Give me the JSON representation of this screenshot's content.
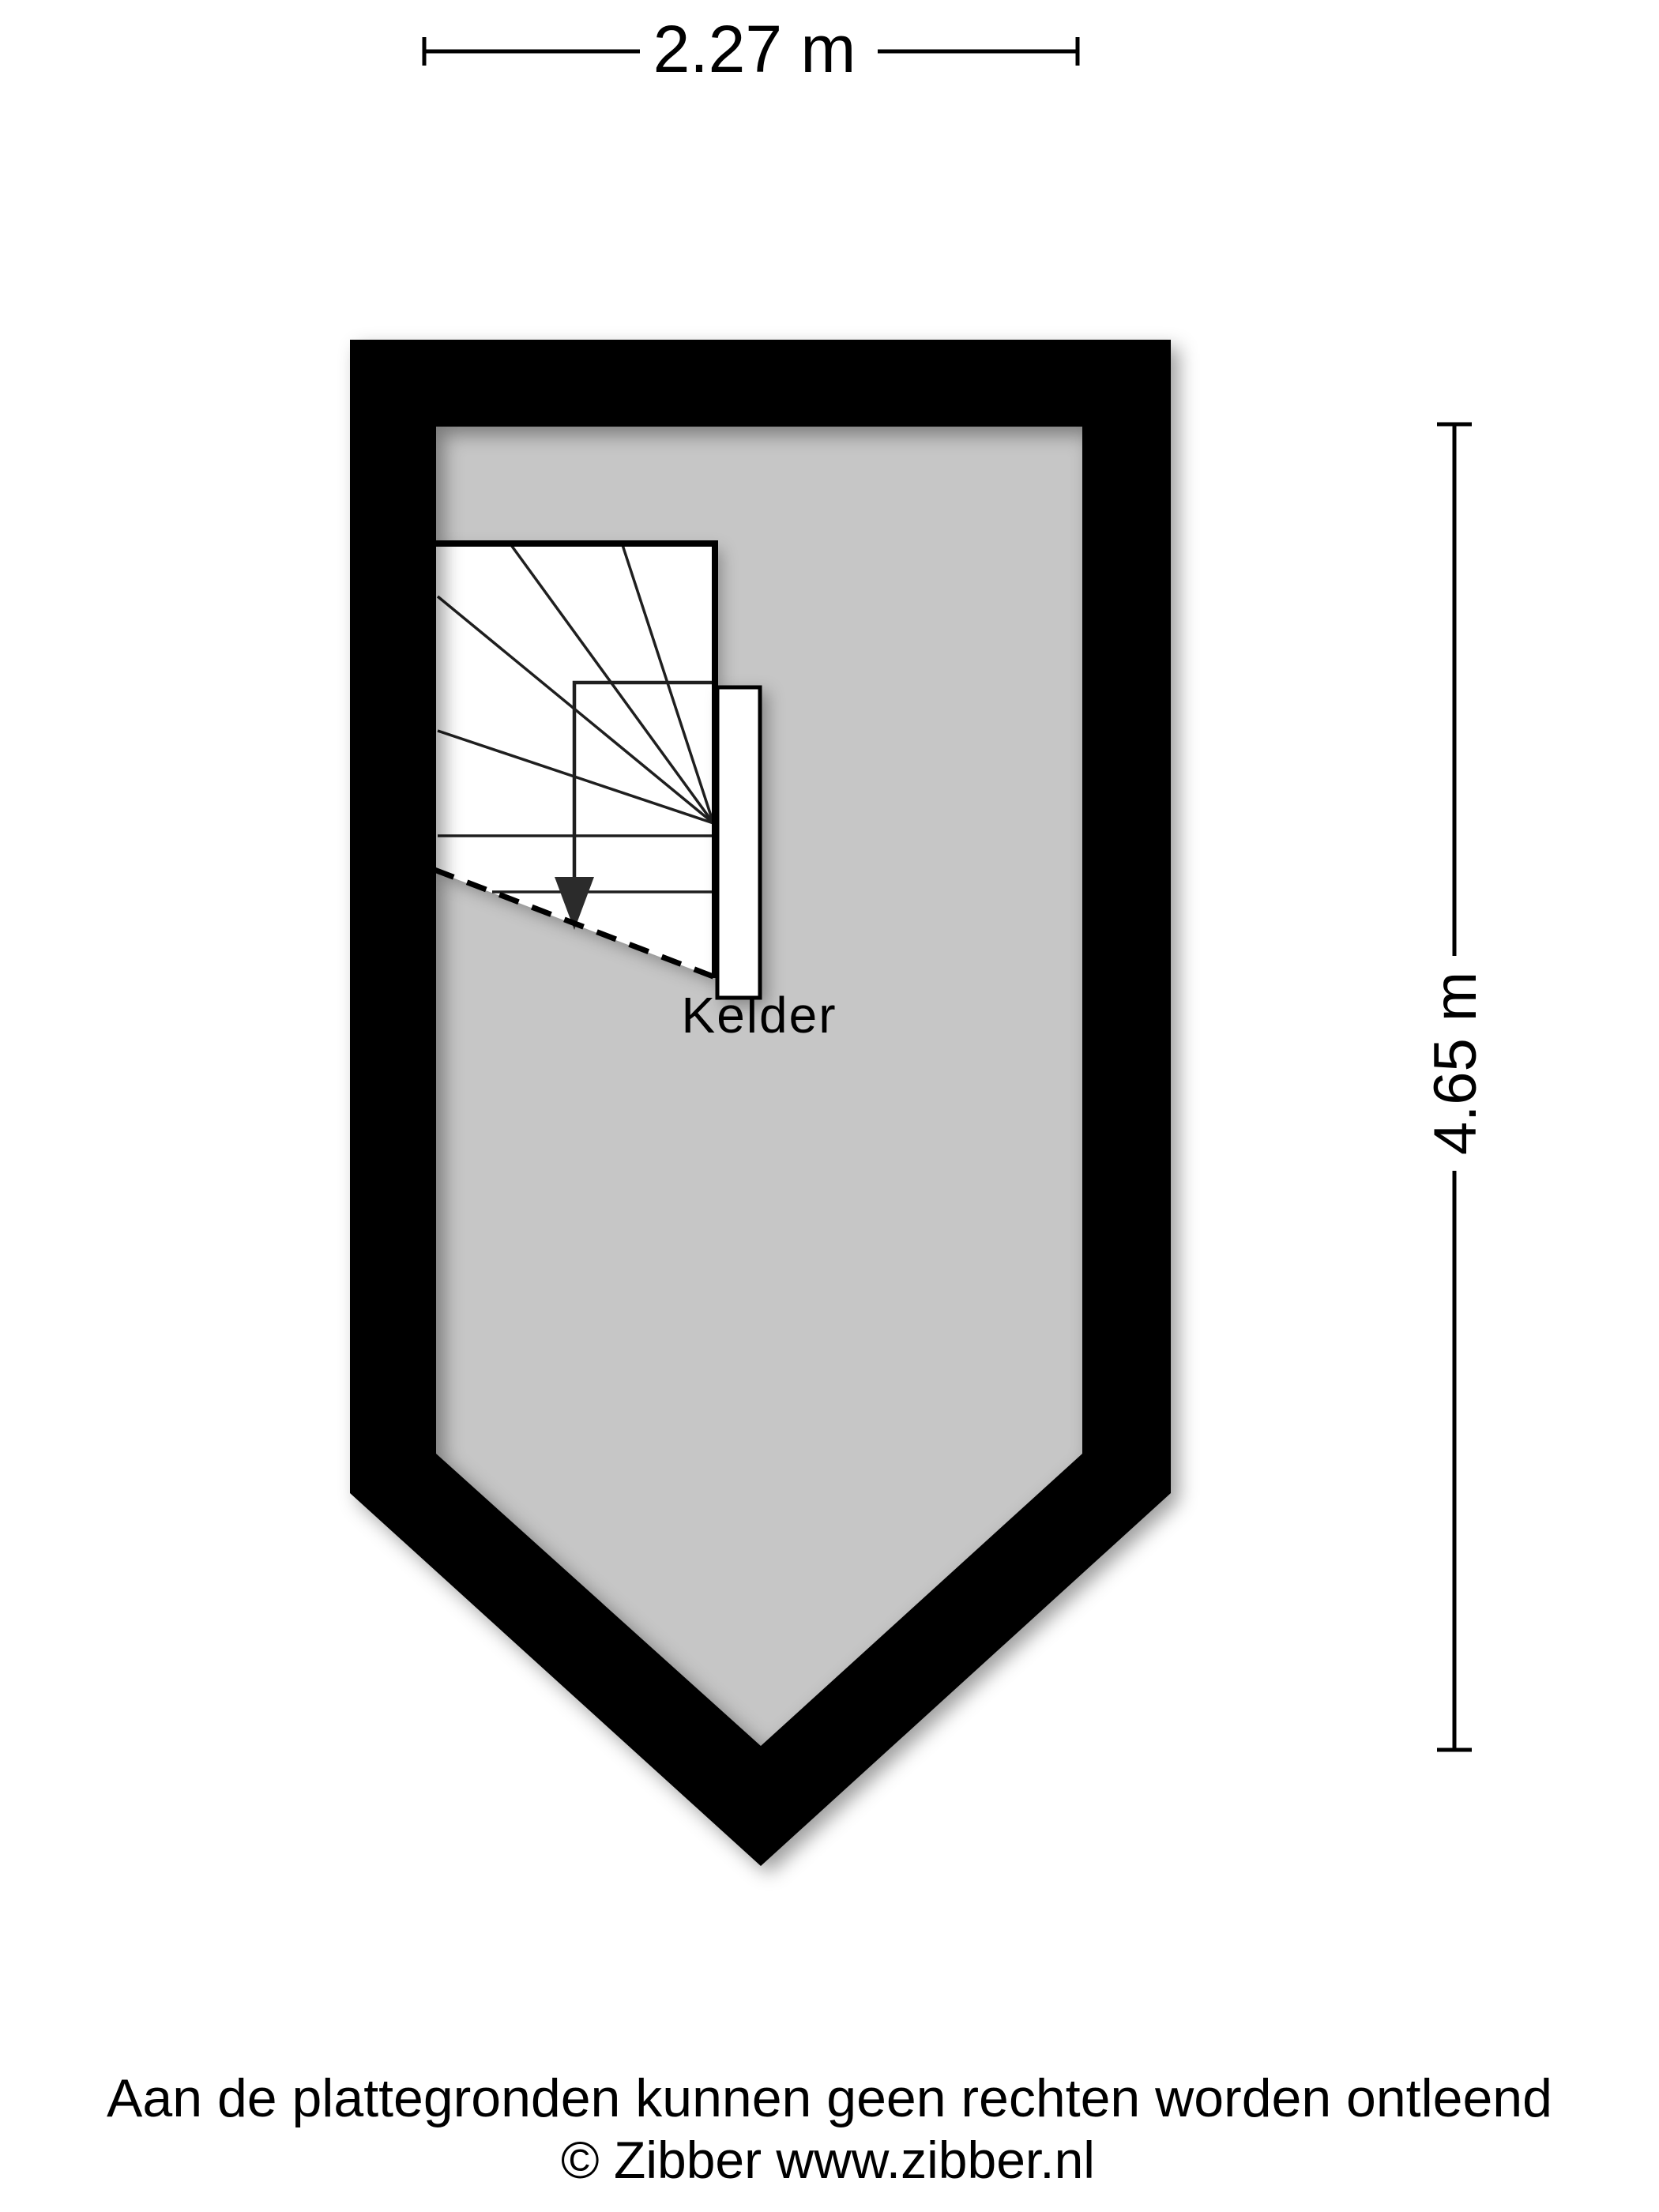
{
  "colors": {
    "background": "#ffffff",
    "wall": "#000000",
    "floor": "#c6c6c6",
    "line": "#1f1f1f",
    "text": "#000000"
  },
  "dimensions": {
    "width_label": "2.27 m",
    "height_label": "4.65 m"
  },
  "plan": {
    "room_label": "Kelder"
  },
  "footer": {
    "disclaimer": "Aan de plattegronden kunnen geen rechten worden ontleend",
    "copyright": "© Zibber www.zibber.nl"
  }
}
